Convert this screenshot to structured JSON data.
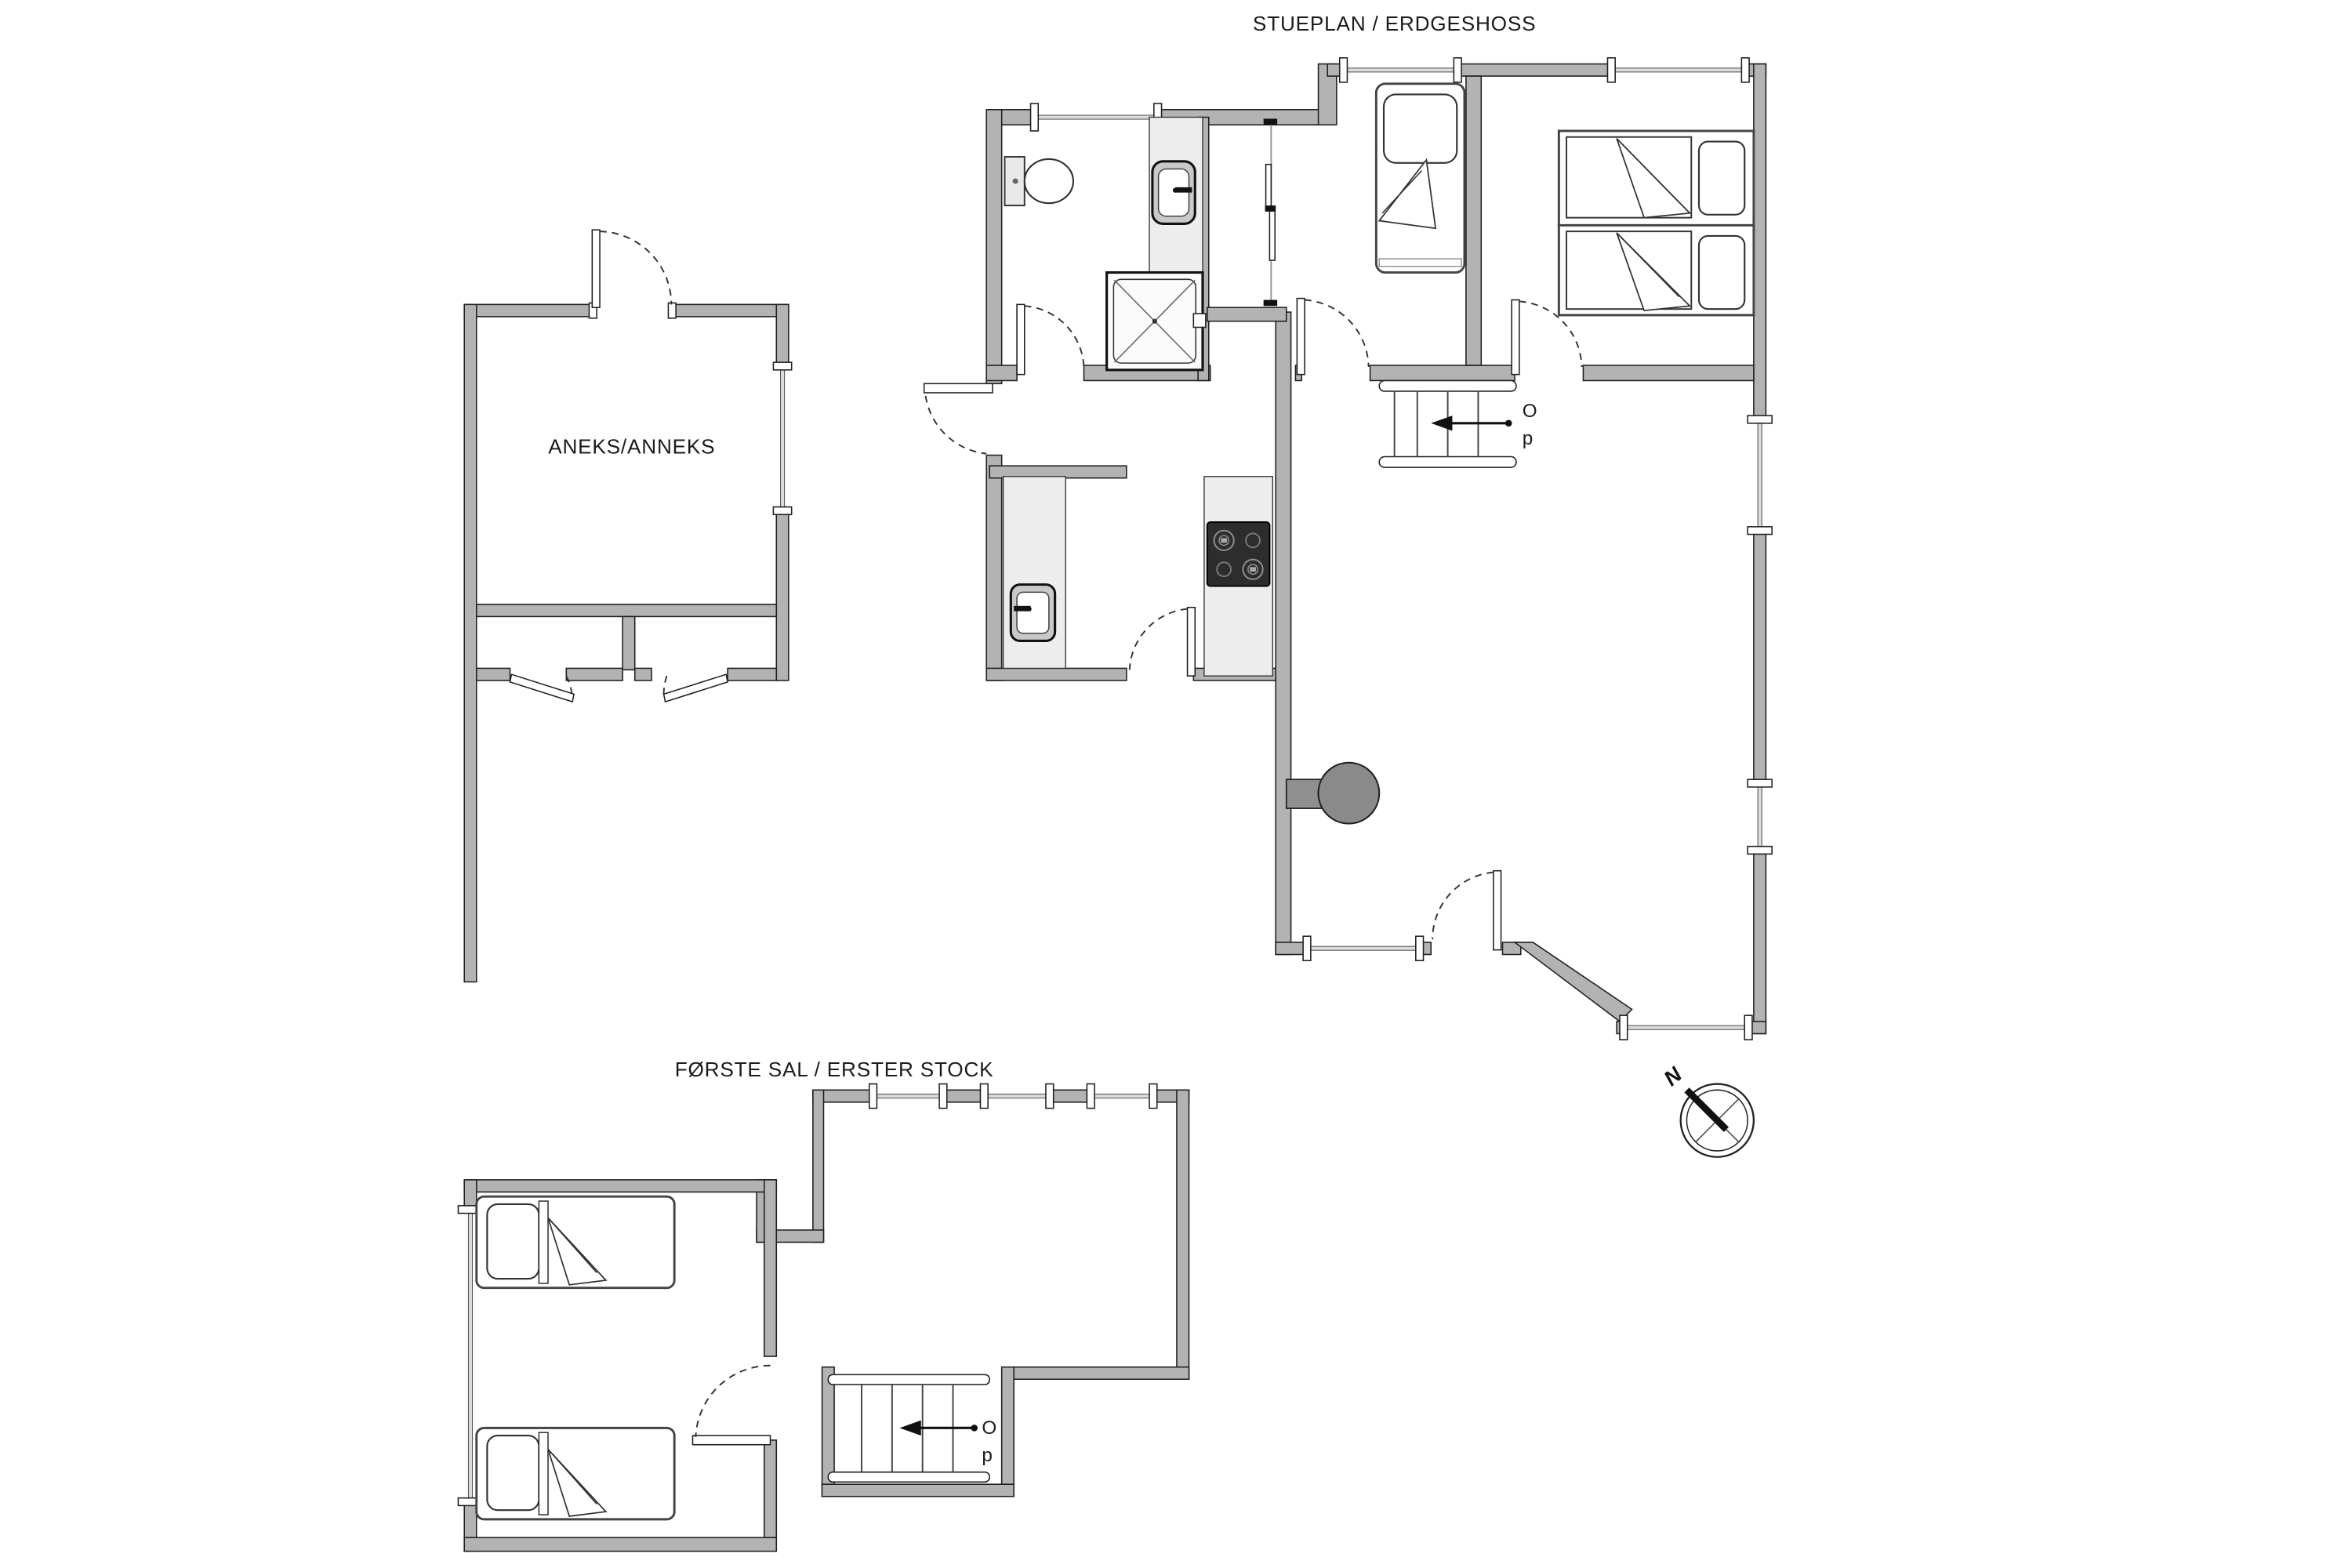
{
  "titles": {
    "ground_floor": "STUEPLAN / ERDGESHOSS",
    "first_floor": "FØRSTE SAL / ERSTER STOCK"
  },
  "annex": {
    "label": "ANEKS/ANNEKS"
  },
  "stairs": {
    "full_label": "Op",
    "label_char_top": "O",
    "label_char_bottom": "p",
    "direction": "up",
    "arrow": "left"
  },
  "compass": {
    "north": "N",
    "needle_points": "north-west"
  },
  "fixtures": {
    "ground_floor": [
      "toilet",
      "washbasin-vanity",
      "shower",
      "sliding-door-closet",
      "single-bed",
      "twin-bed",
      "twin-bed",
      "kitchen-counter-sink",
      "kitchen-island-cooktop",
      "wood-stove",
      "staircase-up"
    ],
    "first_floor": [
      "single-bed",
      "single-bed",
      "staircase-up"
    ],
    "annex": [
      "main-room",
      "shed-left",
      "shed-right"
    ]
  },
  "colors": {
    "wall_fill": "#b3b3b3",
    "wall_outline": "#1f1f1f",
    "counter_fill": "#ededed",
    "window_glass": "#dcdcdc",
    "cooktop": "#2d2d2d",
    "wood_stove": "#8a8a8a",
    "text": "#1b1b1b",
    "background": "#ffffff"
  }
}
